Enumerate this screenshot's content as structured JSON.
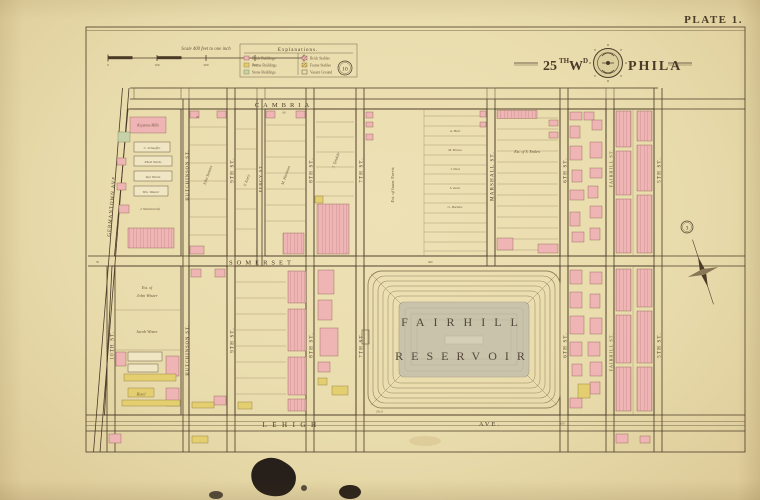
{
  "plate": {
    "label": "PLATE 1."
  },
  "title": {
    "num": "25",
    "num_sup": "TH",
    "wd": "W",
    "wd_sup": "D",
    "city": "PHILA"
  },
  "scale": {
    "label": "Scale 400 feet to one inch",
    "ticks": [
      "0",
      "100",
      "200",
      "300",
      "400"
    ]
  },
  "legend": {
    "title": "Explanations.",
    "items": [
      {
        "label": "Brick Buildings",
        "swatch": "brick"
      },
      {
        "label": "Frame Buildings",
        "swatch": "frame"
      },
      {
        "label": "Stone Buildings",
        "swatch": "stone"
      },
      {
        "label": "Brick Stables",
        "swatch": "brick-hatch"
      },
      {
        "label": "Frame Stables",
        "swatch": "frame-hatch"
      },
      {
        "label": "Vacant Ground",
        "swatch": "outline"
      }
    ]
  },
  "streets": {
    "cambria": "CAMBRIA",
    "somerset": "SOMERSET",
    "lehigh": "LEHIGH",
    "ave": "AVE.",
    "tenth": "10TH ST.",
    "hutchinson": "HUTCHINSON ST.",
    "ninth": "9TH ST.",
    "percy": "PERCY ST.",
    "eighth": "8TH ST.",
    "seventh": "7TH ST.",
    "marshall": "MARSHALL ST.",
    "sixth": "6TH ST.",
    "fairhill": "FAIRHILL ST.",
    "fifth": "5TH ST.",
    "germantown": "GERMANTOWN AVE."
  },
  "reservoir": {
    "line1": "FAIRHILL",
    "line2": "RESERVOIR"
  },
  "refs": {
    "top": "10",
    "right": "3"
  },
  "props": {
    "mill1": "Keystone Mills",
    "mill2": "C. Schaeffer",
    "mill3": "Plush Works",
    "mill4": "Dye Works",
    "mill5": "Wm. Weaver",
    "mill6": "J. Wolstencroft",
    "est1a": "Est. of",
    "est1b": "John Wister",
    "est2": "Jacob Wister",
    "est3": "Est. of Isaac Norris",
    "est4": "Est. of S. Emlen",
    "hotel": "Hotel",
    "name1": "John Somers",
    "name2": "P. Keely",
    "name3": "M. Hartman",
    "name4": "J. Tyndale",
    "row1": "A. Hart",
    "row2": "M. Brown",
    "row3": "J. Paul",
    "row4": "S. Keen",
    "row5": "G. Bockius"
  },
  "dims": {
    "w1": "60",
    "w2": "50",
    "w3": "100",
    "w4": "400",
    "w5": "20",
    "w6": "231.6"
  },
  "colors": {
    "paper": "#eaddae",
    "ink": "#4a3b28",
    "brick": "#efb4b4",
    "frame": "#e4cf70",
    "stone": "#c8d2a8",
    "reservoir_basin": "#ccc5ae"
  }
}
